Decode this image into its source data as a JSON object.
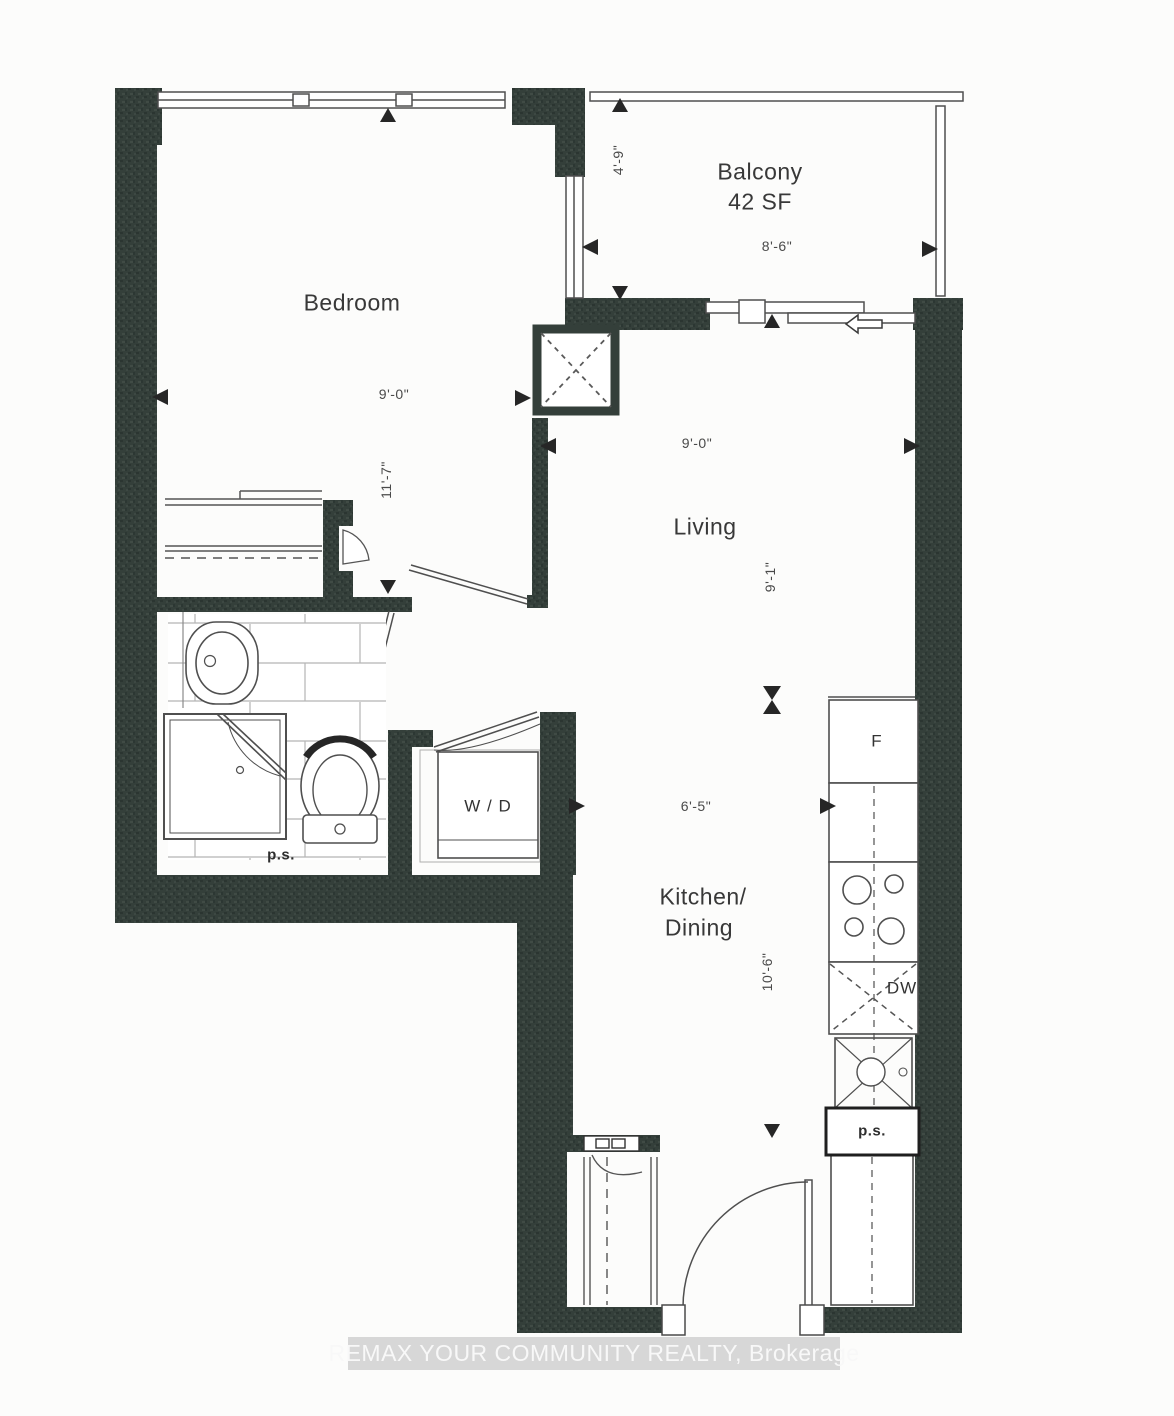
{
  "plan": {
    "watermark": "REMAX YOUR COMMUNITY REALTY, Brokerage",
    "rooms": {
      "bedroom": {
        "label": "Bedroom",
        "width_dim": "9'-0\"",
        "depth_dim": "11'-7\""
      },
      "balcony": {
        "label": "Balcony",
        "area": "42 SF",
        "width_dim": "8'-6\"",
        "depth_dim": "4'-9\""
      },
      "living": {
        "label": "Living",
        "width_dim": "9'-0\"",
        "depth_dim": "9'-1\""
      },
      "kitchen": {
        "label_line1": "Kitchen/",
        "label_line2": "Dining",
        "width_dim": "6'-5\"",
        "depth_dim": "10'-6\""
      }
    },
    "fixtures": {
      "washer_dryer": "W / D",
      "fridge": "F",
      "dishwasher": "DW",
      "pipe_shaft_bath": "p.s.",
      "pipe_shaft_kitchen": "p.s."
    },
    "colors": {
      "wall": "#343f3a",
      "line": "#4f4f4f",
      "watermark_band": "#d7d7d7",
      "watermark_text": "#f8f8f8"
    }
  }
}
